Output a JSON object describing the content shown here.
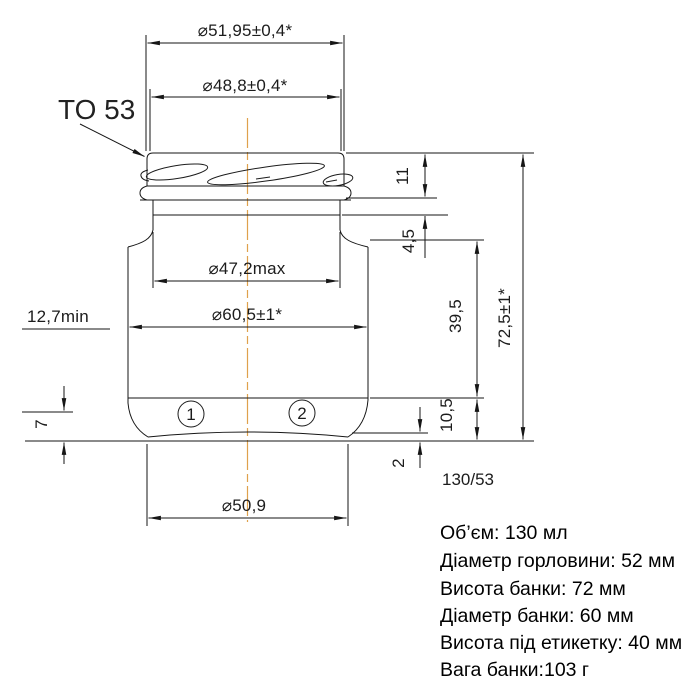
{
  "drawing": {
    "finish_label": "TO 53",
    "code": "130/53",
    "dimensions": {
      "top_outer": "⌀51,95±0,4*",
      "top_thread": "⌀48,8±0,4*",
      "neck_max": "⌀47,2max",
      "body_diameter": "⌀60,5±1*",
      "bottom_diameter": "⌀50,9",
      "label_min": "12,7min",
      "finish_height": "11",
      "neck_height": "4,5",
      "label_height": "39,5",
      "total_height": "72,5±1*",
      "heel_height": "10,5",
      "pushup_height": "2",
      "base_height": "7"
    },
    "mold_marks": [
      "1",
      "2"
    ]
  },
  "specs": {
    "lines": [
      "Об’єм: 130 мл",
      "Діаметр горловини: 52 мм",
      "Висота банки: 72 мм",
      "Діаметр банки: 60 мм",
      "Висота під етикетку: 40 мм",
      "Вага банки:103  г"
    ]
  },
  "colors": {
    "centerline": "#dfa14d",
    "line": "#161616"
  }
}
